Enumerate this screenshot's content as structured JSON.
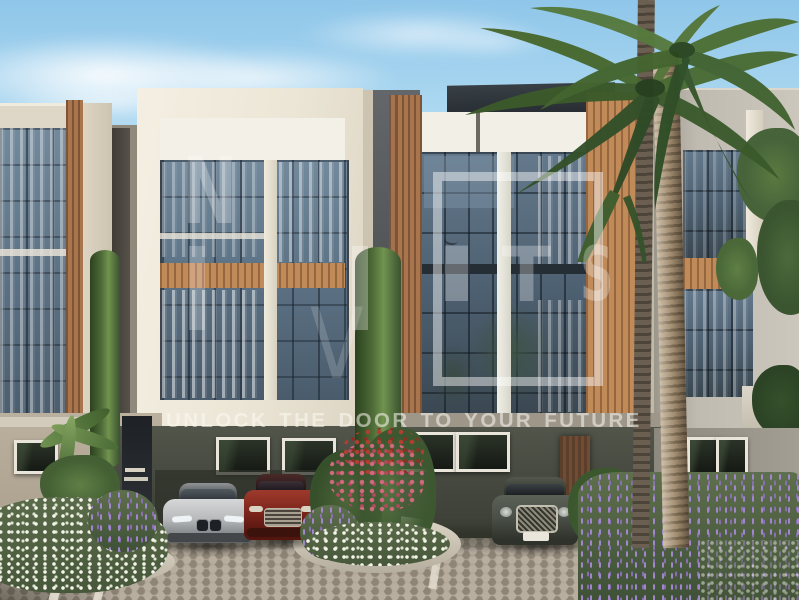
{
  "watermark": {
    "logo": {
      "letter_n": "N",
      "letter_v": "V",
      "letter_i": "I",
      "letter_t": "T",
      "letter_s": "S"
    },
    "tagline": "UNLOCK THE DOOR TO YOUR FUTURE"
  },
  "colors": {
    "sky_blue": "#a9d3ee",
    "facade_white": "#eee8da",
    "glass_blue_gray": "#5d7386",
    "wood_accent": "#a9754c",
    "ground_floor_wall": "#45493f",
    "pavement_gray": "#a69d90",
    "watermark_white": "rgba(255,255,255,0.52)",
    "car_silver": "#c0c2c4",
    "car_red": "#7c241c",
    "car_suv_gray_green": "#4a4f47",
    "lavender_purple": "#9a7fc0"
  }
}
